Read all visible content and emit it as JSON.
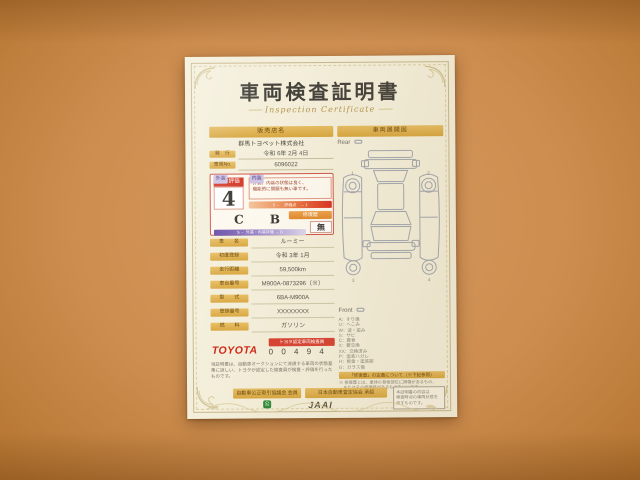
{
  "colors": {
    "background": "#cd8d4f",
    "paper": "#f4efdb",
    "gold_bar": "#d7a640",
    "rating_red": "#d43c2c",
    "toyota_red": "#d02818",
    "scale_purple": "#6a4fa8",
    "green_mark": "#2e8b3a"
  },
  "certificate": {
    "title": "車両検査証明書",
    "subtitle": "Inspection Certificate",
    "decor": "────"
  },
  "left": {
    "dealer_header": "販売店名",
    "dealer_name": "群馬トヨペット株式会社",
    "issue": {
      "label": "発　行",
      "value": "令和 6年 2月 4日"
    },
    "vehicle_no": {
      "label": "車両No.",
      "value": "6096022"
    },
    "rating": {
      "label": "総合評価",
      "value": "4",
      "comment1": "外装、内装の状態は良く、",
      "comment2": "機能的に問題も無い車です。",
      "scale_text": "5 ←　評価点　→ 1",
      "exterior_label": "外装",
      "exterior_value": "C",
      "interior_label": "内装",
      "interior_value": "B",
      "repair_label": "修復歴",
      "repair_value": "無",
      "sub_scale_text": "S ← 外装・内装評価 → D"
    },
    "fields": [
      {
        "label": "車　　名",
        "value": "ルーミー"
      },
      {
        "label": "初度登録",
        "value": "令和 3年 1月"
      },
      {
        "label": "走行距離",
        "value": "59,500km"
      },
      {
        "label": "車台番号",
        "value": "M900A-0873296（※）"
      },
      {
        "label": "型　　式",
        "value": "6BA-M900A"
      },
      {
        "label": "登録番号",
        "value": "XXXXXXXX"
      },
      {
        "label": "燃　　料",
        "value": "ガソリン"
      }
    ],
    "toyota": {
      "logo": "TOYOTA",
      "badge": "トヨタ認定車両検査員",
      "inspector_no": "0 0 4 9 4"
    },
    "disclaimer": "当証明書は、自動車オークションにて流通する車両の状態基準に詳しい、トヨタが認定した検査員が検査・評価を行ったものです。"
  },
  "right": {
    "header": "車両展開図",
    "rear_label": "Rear",
    "front_label": "Front",
    "markers": [
      "1",
      "2",
      "3",
      "4"
    ],
    "legend": [
      "A：すり傷",
      "U：へこみ",
      "W：波・歪み",
      "S：サビ",
      "C：腐食",
      "X：要交換",
      "XX：交換済み",
      "P：塗装ハガレ",
      "H：板金・塗装跡",
      "G：ガラス傷"
    ],
    "repair_ribbon": "「修復歴」の定義について（※下記参照）",
    "repair_notes": [
      "※ 修復歴とは、車体の骨格部位に損傷があるもの、",
      "　またはその修復跡があるものをいいます。"
    ]
  },
  "footer": {
    "fair_trade": "自動車公正取引協議会 会員",
    "green_mark": "公",
    "jaai_label": "日本自動車査定協会 承認",
    "jaai_logo": "JAAI",
    "note_lines": [
      "本証明書の内容は",
      "検査時点の車両状態を",
      "示すものです。"
    ]
  }
}
